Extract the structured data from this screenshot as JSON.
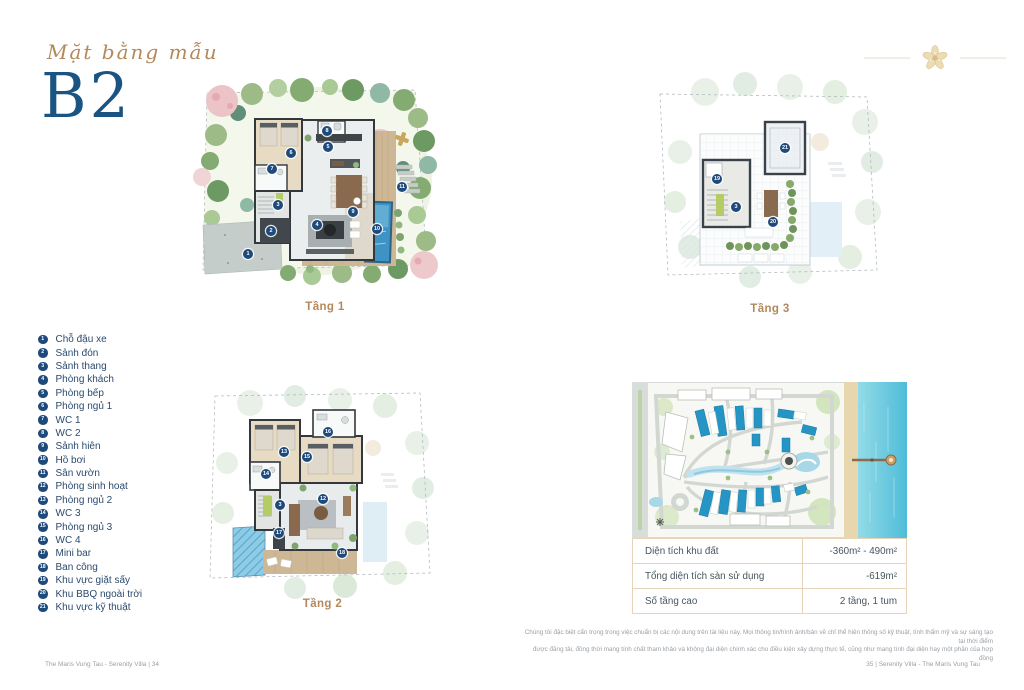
{
  "header": {
    "title_script": "Mặt bằng mẫu",
    "title_code": "B2"
  },
  "plans": {
    "tang1": {
      "label": "Tầng 1",
      "markers": [
        {
          "n": 1,
          "x": 58,
          "y": 181
        },
        {
          "n": 2,
          "x": 81,
          "y": 158
        },
        {
          "n": 3,
          "x": 88,
          "y": 132
        },
        {
          "n": 4,
          "x": 127,
          "y": 152
        },
        {
          "n": 5,
          "x": 138,
          "y": 74
        },
        {
          "n": 6,
          "x": 101,
          "y": 80
        },
        {
          "n": 7,
          "x": 82,
          "y": 96
        },
        {
          "n": 8,
          "x": 137,
          "y": 58
        },
        {
          "n": 9,
          "x": 163,
          "y": 139
        },
        {
          "n": 10,
          "x": 187,
          "y": 156
        },
        {
          "n": 11,
          "x": 212,
          "y": 114
        }
      ]
    },
    "tang2": {
      "label": "Tầng 2",
      "markers": [
        {
          "n": 13,
          "x": 79,
          "y": 74
        },
        {
          "n": 16,
          "x": 123,
          "y": 54
        },
        {
          "n": 15,
          "x": 102,
          "y": 79
        },
        {
          "n": 14,
          "x": 61,
          "y": 96
        },
        {
          "n": 3,
          "x": 75,
          "y": 127
        },
        {
          "n": 12,
          "x": 118,
          "y": 121
        },
        {
          "n": 17,
          "x": 74,
          "y": 155
        },
        {
          "n": 18,
          "x": 137,
          "y": 175
        }
      ]
    },
    "tang3": {
      "label": "Tầng 3",
      "markers": [
        {
          "n": 21,
          "x": 135,
          "y": 86
        },
        {
          "n": 19,
          "x": 67,
          "y": 117
        },
        {
          "n": 3,
          "x": 86,
          "y": 145
        },
        {
          "n": 20,
          "x": 123,
          "y": 160
        }
      ]
    }
  },
  "legend": {
    "items": [
      {
        "num": 1,
        "label": "Chỗ đậu xe"
      },
      {
        "num": 2,
        "label": "Sảnh đón"
      },
      {
        "num": 3,
        "label": "Sảnh thang"
      },
      {
        "num": 4,
        "label": "Phòng khách"
      },
      {
        "num": 5,
        "label": "Phòng bếp"
      },
      {
        "num": 6,
        "label": "Phòng ngủ 1"
      },
      {
        "num": 7,
        "label": "WC 1"
      },
      {
        "num": 8,
        "label": "WC 2"
      },
      {
        "num": 9,
        "label": "Sảnh hiên"
      },
      {
        "num": 10,
        "label": "Hồ bơi"
      },
      {
        "num": 11,
        "label": "Sân vườn"
      },
      {
        "num": 12,
        "label": "Phòng sinh hoạt"
      },
      {
        "num": 13,
        "label": "Phòng ngủ 2"
      },
      {
        "num": 14,
        "label": "WC 3"
      },
      {
        "num": 15,
        "label": "Phòng ngủ 3"
      },
      {
        "num": 16,
        "label": "WC 4"
      },
      {
        "num": 17,
        "label": "Mini bar"
      },
      {
        "num": 18,
        "label": "Ban công"
      },
      {
        "num": 19,
        "label": "Khu vực giặt sấy"
      },
      {
        "num": 20,
        "label": "Khu BBQ ngoài trời"
      },
      {
        "num": 21,
        "label": "Khu vực kỹ thuật"
      }
    ]
  },
  "info_table": {
    "rows": [
      {
        "label": "Diện tích khu đất",
        "value": "-360m² - 490m²"
      },
      {
        "label": "Tổng diện tích sàn sử dụng",
        "value": "-619m²"
      },
      {
        "label": "Số tầng cao",
        "value": "2 tầng, 1 tum"
      }
    ]
  },
  "footer": {
    "disclaimer_line1": "Chúng tôi đặc biệt cẩn trọng trong việc chuẩn bị các nội dung trên tài liệu này. Mọi thông tin/hình ảnh/bản vẽ chỉ thể hiện thông số kỹ thuật, tính thẩm mỹ và sự sáng tạo tại thời điểm",
    "disclaimer_line2": "được đăng tải, đồng thời mang tính chất tham khảo và không đại diện chính xác cho điều kiện xây dựng thực tế, cũng như mang tính đại diện hay một phần của hợp đồng",
    "page_left": "The Maris Vung Tau - Serenity Villa | 34",
    "page_right": "35 | Serenity Villa - The Maris Vung Tau"
  },
  "colors": {
    "navy": "#1d4a7b",
    "title_blue": "#1a5482",
    "tan": "#b3895c",
    "table_border": "#e6d3b8",
    "pool_blue": "#3f93c4",
    "sea_blue": "#5fc4dc"
  }
}
